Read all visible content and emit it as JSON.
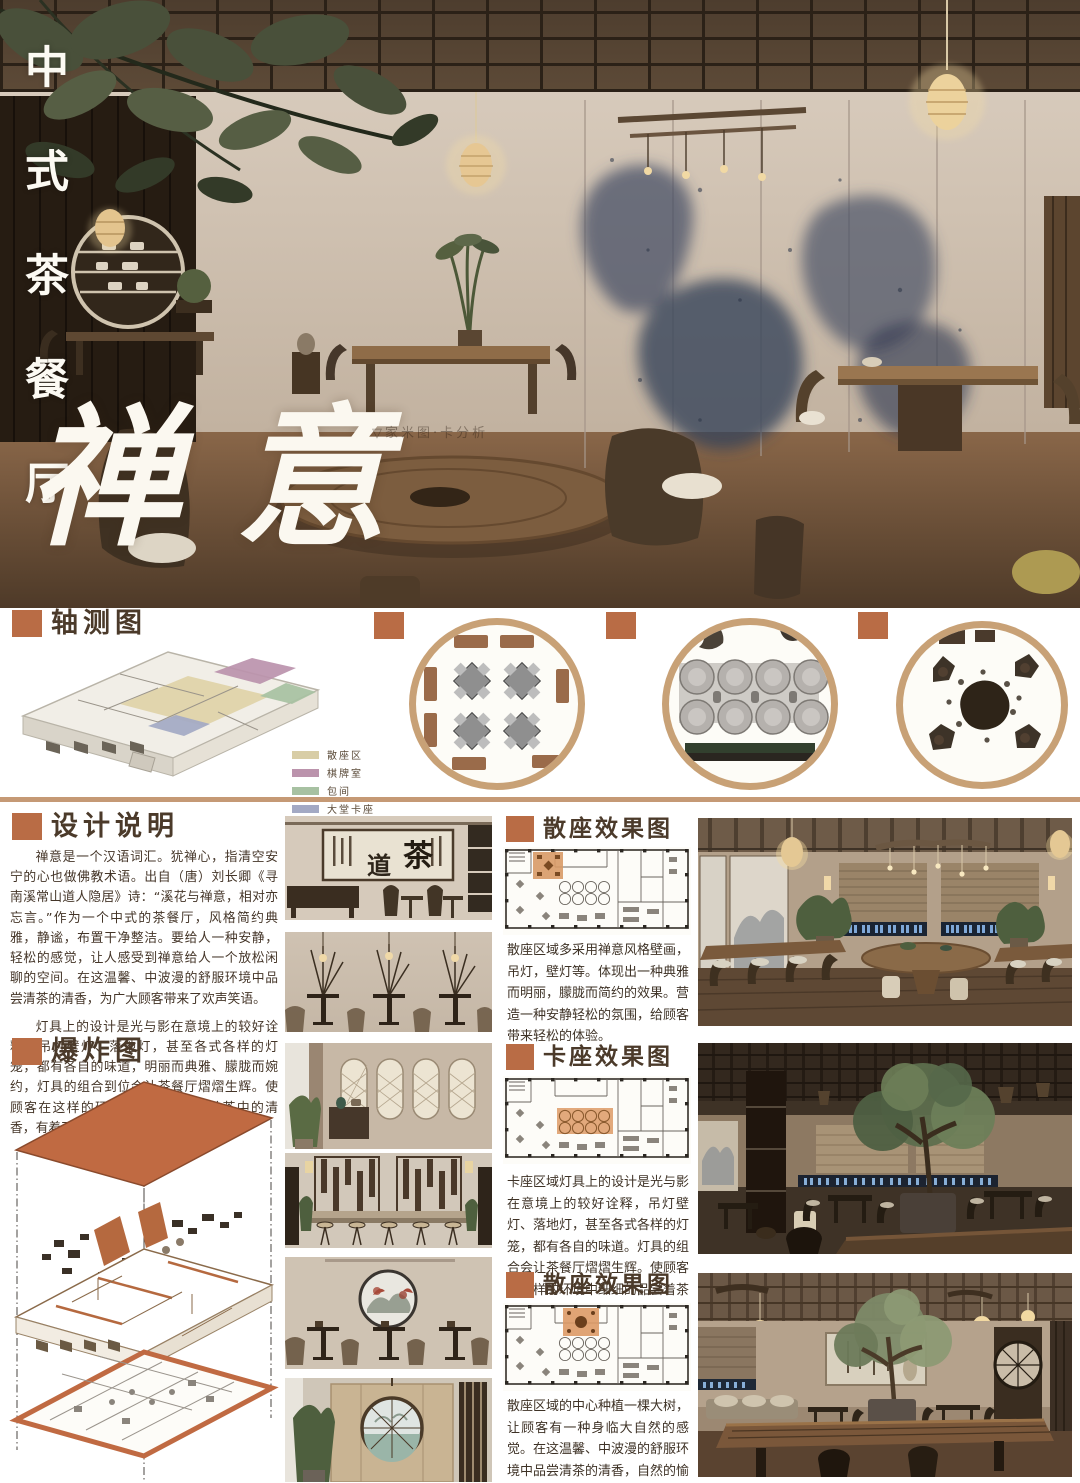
{
  "hero": {
    "vertical_title": "中式茶餐厅",
    "main_title": "禅意",
    "watermark": "▽家米图·卡分析"
  },
  "sections": {
    "axon": {
      "title": "轴测图"
    },
    "design": {
      "title": "设计说明",
      "para1": "禅意是一个汉语词汇。犹禅心，指清空安宁的心也做佛教术语。出自（唐）刘长卿《寻南溪常山道人隐居》诗：“溪花与禅意，相对亦忘言。”作为一个中式的茶餐厅，风格简约典雅，静谧，布置干净整洁。要给人一种安静，轻松的感觉，让人感受到禅意给人一个放松闲聊的空间。在这温馨、中波漫的舒服环境中品尝清茶的清香，为广大顾客带来了欢声笑语。",
      "para2": "灯具上的设计是光与影在意境上的较好诠释，吊灯壁灯、落地灯，甚至各式各样的灯笼，都有各自的味道，明丽而典雅、朦胧而婉约，灯具的组合到位会让茶餐厅熠熠生辉。使顾客在这样的环境中细细的品尝着茶中的清香，有着不一样的感受。"
    },
    "exploded": {
      "title": "爆炸图"
    },
    "effects": [
      {
        "title": "散座效果图",
        "text": "散座区域多采用禅意风格壁画，吊灯，壁灯等。体现出一种典雅而明丽，朦胧而简约的效果。营造一种安静轻松的氛围，给顾客带来轻松的体验。"
      },
      {
        "title": "卡座效果图",
        "text": "卡座区域灯具上的设计是光与影在意境上的较好诠释，吊灯壁灯、落地灯，甚至各式各样的灯笼，都有各自的味道。灯具的组合会让茶餐厅熠熠生辉。使顾客在这样的环境中细细的品尝着茶中的清香，有着不一样的感受。"
      },
      {
        "title": "散座效果图",
        "text": "散座区域的中心种植一棵大树，让顾客有一种身临大自然的感觉。在这温馨、中波漫的舒服环境中品尝清茶的清香，自然的愉悦，为广大顾客带来了欢声笑语。"
      }
    ]
  },
  "legend": {
    "items": [
      {
        "label": "散座区",
        "color": "#d8cda6"
      },
      {
        "label": "棋牌室",
        "color": "#bb93ac"
      },
      {
        "label": "包间",
        "color": "#a7c1a2"
      },
      {
        "label": "大堂卡座",
        "color": "#a3a9c4"
      }
    ]
  },
  "elevation_art": {
    "cha": "茶",
    "dao": "道"
  },
  "colors": {
    "accent": "#b96c45",
    "divider": "#c59975",
    "ring": "#c8a176"
  }
}
